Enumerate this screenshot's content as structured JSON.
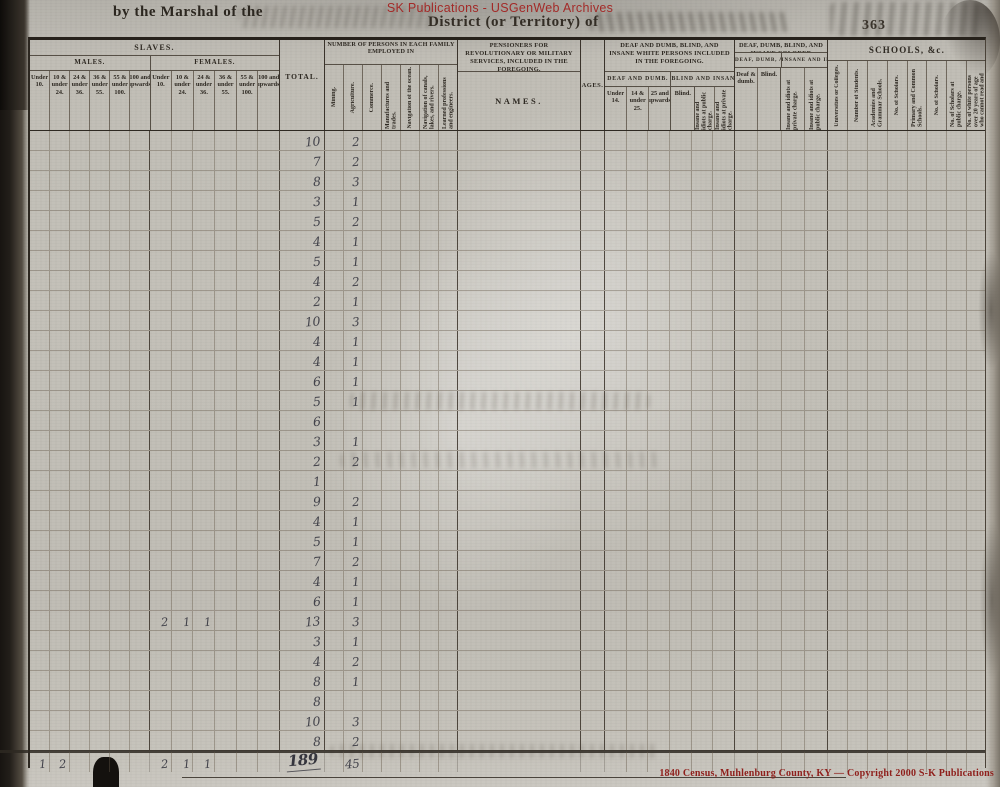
{
  "watermark": {
    "top": "SK Publications - USGenWeb Archives",
    "bottom": "1840 Census, Muhlenburg County, KY — Copyright 2000 S-K Publications"
  },
  "page_header": {
    "left": "by the Marshal of the",
    "center": "District (or Territory) of",
    "page_number": "363"
  },
  "table": {
    "slaves": {
      "title": "SLAVES.",
      "males": {
        "title": "MALES.",
        "columns": [
          "Under 10.",
          "10 & under 24.",
          "24 & under 36.",
          "36 & under 55.",
          "55 & under 100.",
          "100 and upwards."
        ]
      },
      "females": {
        "title": "FEMALES.",
        "columns": [
          "Under 10.",
          "10 & under 24.",
          "24 & under 36.",
          "36 & under 55.",
          "55 & under 100.",
          "100 and upwards."
        ]
      }
    },
    "total_label": "TOTAL.",
    "employment": {
      "title": "NUMBER OF PERSONS IN EACH FAMILY EMPLOYED IN",
      "columns": [
        "Mining.",
        "Agriculture.",
        "Commerce.",
        "Manufactures and trades.",
        "Navigation of the ocean.",
        "Navigation of canals, lakes, and rivers.",
        "Learned professions and engineers."
      ]
    },
    "pensioners": {
      "title": "PENSIONERS FOR REVOLUTIONARY OR MILITARY SERVICES, INCLUDED IN THE FOREGOING.",
      "names_label": "NAMES.",
      "ages_label": "AGES."
    },
    "white_impaired": {
      "title": "DEAF AND DUMB, BLIND, AND INSANE WHITE PERSONS INCLUDED IN THE FOREGOING.",
      "deaf_dumb": {
        "title": "DEAF AND DUMB.",
        "columns": [
          "Under 14.",
          "14 & under 25.",
          "25 and upwards."
        ]
      },
      "blind_insane": {
        "title": "BLIND AND INSANE.",
        "columns_h": [
          "Blind."
        ],
        "columns_v": [
          "Insane and idiots at public charge.",
          "Insane and idiots at private charge."
        ]
      }
    },
    "colored_impaired": {
      "title": "DEAF, DUMB, BLIND, AND INSANE COLORED PERSONS INCLUDED IN THE FOREGOING.",
      "deaf_dumb_blind": {
        "title": "DEAF, DUMB, AND BLIND.",
        "columns": [
          "Deaf & dumb.",
          "Blind."
        ]
      },
      "insane_idiots": {
        "title": "INSANE AND IDIOTS.",
        "columns": [
          "Insane and idiots at private charge.",
          "Insane and idiots at public charge."
        ]
      }
    },
    "schools": {
      "title": "SCHOOLS, &c.",
      "columns": [
        "Universities or Colleges.",
        "Number of Students.",
        "Academies and Grammar Schools.",
        "No. of Scholars.",
        "Primary and Common Schools.",
        "No. of Scholars.",
        "No. of Scholars at public charge.",
        "No. of white persons over 20 years of age who cannot read and write."
      ]
    }
  },
  "rows": [
    {
      "total": "10",
      "ag": "2"
    },
    {
      "total": "7",
      "ag": "2"
    },
    {
      "total": "8",
      "ag": "3"
    },
    {
      "total": "3",
      "ag": "1"
    },
    {
      "total": "5",
      "ag": "2"
    },
    {
      "total": "4",
      "ag": "1"
    },
    {
      "total": "5",
      "ag": "1"
    },
    {
      "total": "4",
      "ag": "2"
    },
    {
      "total": "2",
      "ag": "1"
    },
    {
      "total": "10",
      "ag": "3"
    },
    {
      "total": "4",
      "ag": "1"
    },
    {
      "total": "4",
      "ag": "1"
    },
    {
      "total": "6",
      "ag": "1"
    },
    {
      "total": "5",
      "ag": "1"
    },
    {
      "total": "6",
      "ag": ""
    },
    {
      "total": "3",
      "ag": "1"
    },
    {
      "total": "2",
      "ag": "2"
    },
    {
      "total": "1",
      "ag": ""
    },
    {
      "total": "9",
      "ag": "2"
    },
    {
      "total": "4",
      "ag": "1"
    },
    {
      "total": "5",
      "ag": "1"
    },
    {
      "total": "7",
      "ag": "2"
    },
    {
      "total": "4",
      "ag": "1"
    },
    {
      "total": "6",
      "ag": "1"
    },
    {
      "total": "13",
      "ag": "3",
      "f": [
        "2",
        "1",
        "1"
      ]
    },
    {
      "total": "3",
      "ag": "1"
    },
    {
      "total": "4",
      "ag": "2"
    },
    {
      "total": "8",
      "ag": "1"
    },
    {
      "total": "8",
      "ag": ""
    },
    {
      "total": "10",
      "ag": "3"
    },
    {
      "total": "8",
      "ag": "2"
    }
  ],
  "totals_row": {
    "m": [
      "1",
      "2",
      "",
      "",
      "",
      ""
    ],
    "f": [
      "2",
      "1",
      "1",
      "",
      "",
      ""
    ],
    "total": "189",
    "ag": "45"
  }
}
